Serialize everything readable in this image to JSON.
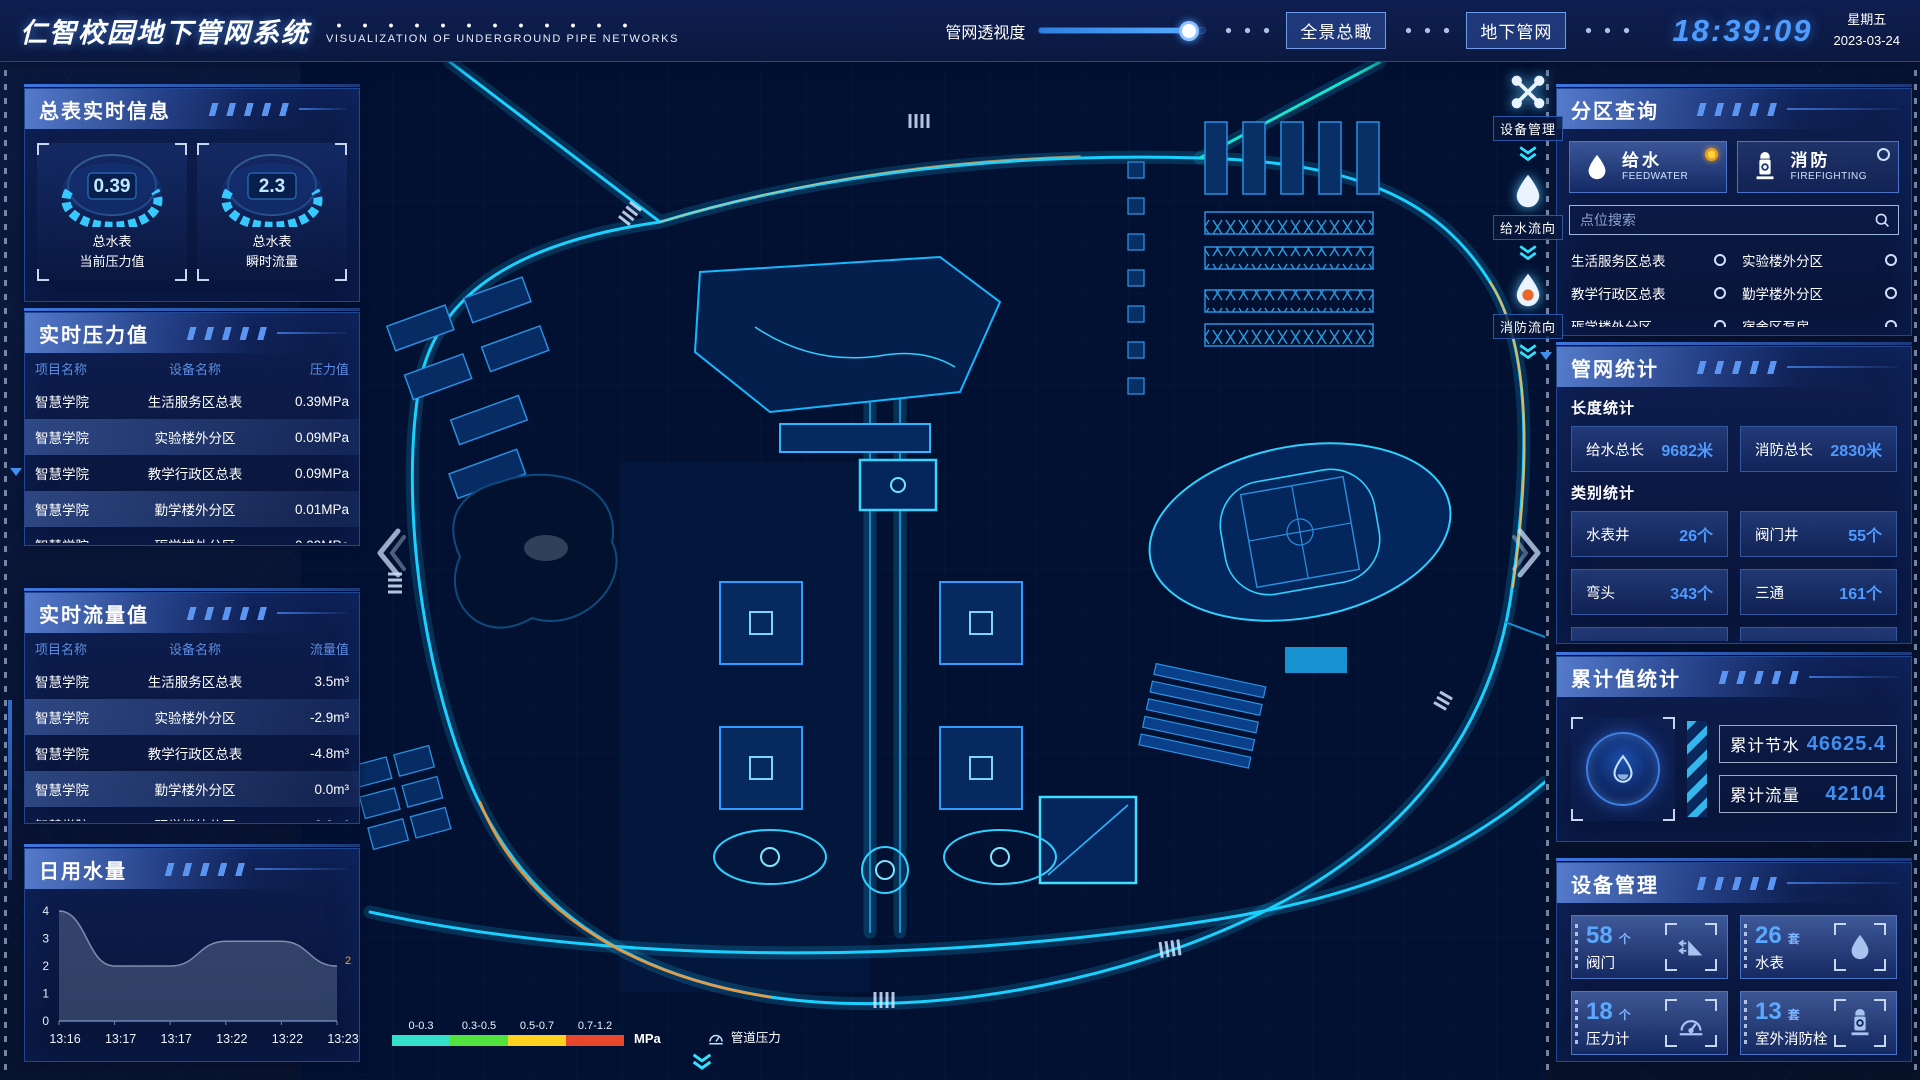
{
  "header": {
    "title": "仁智校园地下管网系统",
    "subtitle": "VISUALIZATION OF UNDERGROUND PIPE NETWORKS",
    "transparency_label": "管网透视度",
    "buttons": [
      {
        "label": "全景总瞰"
      },
      {
        "label": "地下管网"
      }
    ],
    "clock": "18:39:09",
    "weekday": "星期五",
    "date": "2023-03-24"
  },
  "left": {
    "gauges": {
      "title": "总表实时信息",
      "cards": [
        {
          "value": "0.39",
          "line1": "总水表",
          "line2": "当前压力值"
        },
        {
          "value": "2.3",
          "line1": "总水表",
          "line2": "瞬时流量"
        }
      ]
    },
    "pressure": {
      "title": "实时压力值",
      "columns": [
        "项目名称",
        "设备名称",
        "压力值"
      ],
      "rows": [
        [
          "智慧学院",
          "生活服务区总表",
          "0.39MPa"
        ],
        [
          "智慧学院",
          "实验楼外分区",
          "0.09MPa"
        ],
        [
          "智慧学院",
          "教学行政区总表",
          "0.09MPa"
        ],
        [
          "智慧学院",
          "勤学楼外分区",
          "0.01MPa"
        ],
        [
          "智慧学院",
          "砺学楼外分区",
          "0.09MPa"
        ]
      ]
    },
    "flow": {
      "title": "实时流量值",
      "columns": [
        "项目名称",
        "设备名称",
        "流量值"
      ],
      "rows": [
        [
          "智慧学院",
          "生活服务区总表",
          "3.5m³"
        ],
        [
          "智慧学院",
          "实验楼外分区",
          "-2.9m³"
        ],
        [
          "智慧学院",
          "教学行政区总表",
          "-4.8m³"
        ],
        [
          "智慧学院",
          "勤学楼外分区",
          "0.0m³"
        ],
        [
          "智慧学院",
          "砺学楼外分区",
          "2.3m³"
        ]
      ]
    },
    "daily": {
      "title": "日用水量",
      "chart": {
        "type": "area",
        "x": [
          "13:16",
          "13:17",
          "13:17",
          "13:22",
          "13:22",
          "13:23"
        ],
        "values": [
          4,
          2,
          2,
          2.9,
          2.9,
          2
        ],
        "ymin": 0,
        "ymax": 4,
        "yticks": [
          0,
          1,
          2,
          3,
          4
        ],
        "end_label": "2"
      }
    }
  },
  "map": {
    "tools": [
      {
        "icon": "wrench-icon",
        "label": "设备管理"
      },
      {
        "icon": "droplet-icon",
        "label": "给水流向"
      },
      {
        "icon": "fire-droplet-icon",
        "label": "消防流向"
      }
    ],
    "legend": {
      "ranges": [
        "0-0.3",
        "0.3-0.5",
        "0.5-0.7",
        "0.7-1.2"
      ],
      "colors": [
        "#35e0c8",
        "#52e23e",
        "#ffd21f",
        "#e8472b"
      ],
      "unit": "MPa",
      "item_label": "管道压力"
    }
  },
  "right": {
    "zone": {
      "title": "分区查询",
      "toggles": [
        {
          "label": "给水",
          "sub": "FEEDWATER",
          "selected": true
        },
        {
          "label": "消防",
          "sub": "FIREFIGHTING",
          "selected": false
        }
      ],
      "search_placeholder": "点位搜索",
      "items": [
        "生活服务区总表",
        "实验楼外分区",
        "教学行政区总表",
        "勤学楼外分区",
        "砺学楼外分区",
        "宿舍区泵房"
      ]
    },
    "stats": {
      "title": "管网统计",
      "length_title": "长度统计",
      "length": [
        {
          "label": "给水总长",
          "value": "9682米"
        },
        {
          "label": "消防总长",
          "value": "2830米"
        }
      ],
      "type_title": "类别统计",
      "types": [
        {
          "label": "水表井",
          "value": "26个"
        },
        {
          "label": "阀门井",
          "value": "55个"
        },
        {
          "label": "弯头",
          "value": "343个"
        },
        {
          "label": "三通",
          "value": "161个"
        }
      ]
    },
    "total": {
      "title": "累计值统计",
      "rows": [
        {
          "label": "累计节水",
          "value": "46625.4"
        },
        {
          "label": "累计流量",
          "value": "42104"
        }
      ]
    },
    "devices": {
      "title": "设备管理",
      "cards": [
        {
          "count": "58",
          "unit": "个",
          "label": "阀门",
          "icon": "valve-icon"
        },
        {
          "count": "26",
          "unit": "套",
          "label": "水表",
          "icon": "water-meter-icon"
        },
        {
          "count": "18",
          "unit": "个",
          "label": "压力计",
          "icon": "pressure-gauge-icon"
        },
        {
          "count": "13",
          "unit": "套",
          "label": "室外消防栓",
          "icon": "hydrant-icon"
        }
      ]
    }
  }
}
